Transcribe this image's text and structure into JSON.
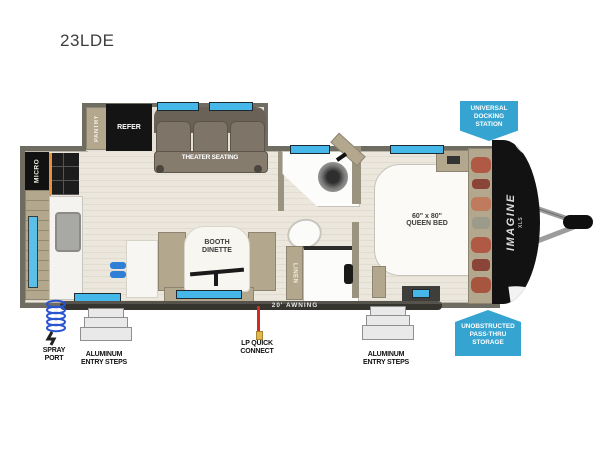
{
  "title": "23LDE",
  "floorplan": {
    "labels": {
      "pantry": "PANTRY",
      "refrigerator": "REFER",
      "theater_seating": "THEATER SEATING",
      "microwave": "MICRO",
      "dinette": [
        "BOOTH",
        "DINETTE"
      ],
      "linen": "LINEN",
      "queen_bed": [
        "60\" x 80\"",
        "QUEEN BED"
      ],
      "brand": "IMAGINE",
      "brand_sub": "XLS"
    }
  },
  "badges": {
    "docking_station": {
      "lines": [
        "UNIVERSAL",
        "DOCKING",
        "STATION"
      ],
      "color": "#35a4d0"
    },
    "pass_thru": {
      "lines": [
        "UNOBSTRUCTED",
        "PASS-THRU",
        "STORAGE"
      ],
      "color": "#35a4d0"
    }
  },
  "callouts": {
    "awning": "20' AWNING",
    "spray_port": [
      "SPRAY",
      "PORT"
    ],
    "entry_steps_rear": [
      "ALUMINUM",
      "ENTRY STEPS"
    ],
    "lp_quick_connect": [
      "LP QUICK",
      "CONNECT"
    ],
    "entry_steps_front": [
      "ALUMINUM",
      "ENTRY STEPS"
    ]
  },
  "colors": {
    "badge_blue": "#35a4d0",
    "window_blue": "#45b7e8",
    "wall_gray": "#6f6c62",
    "floor_beige": "#ece7dd",
    "cabinet_tan": "#b3a88e",
    "front_cap_black": "#121212",
    "lp_red": "#d22b23",
    "spray_blue": "#2b54cf",
    "stove_accent_orange": "#e8923f"
  }
}
